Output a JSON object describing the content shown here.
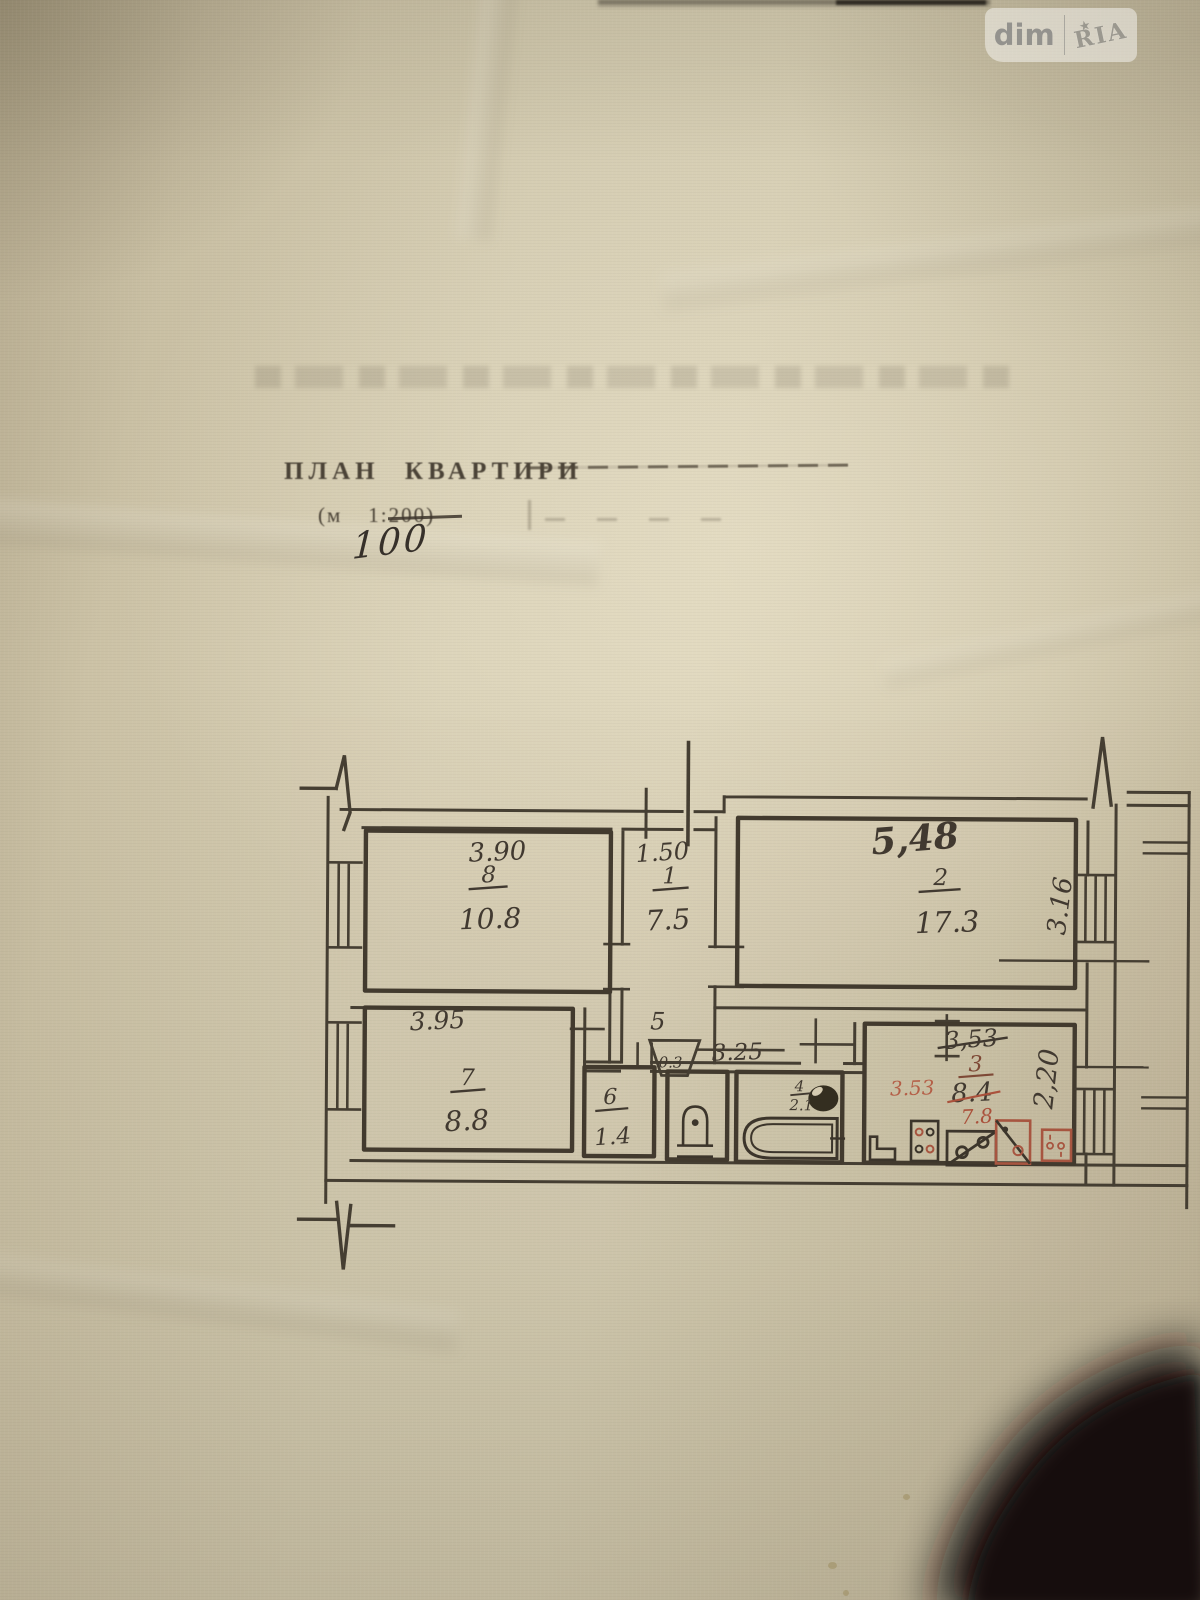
{
  "watermark": {
    "left": "dim",
    "right": "RIA",
    "star": "★"
  },
  "header": {
    "title": "ПЛАН КВАРТИРИ",
    "scale_prefix": "(м",
    "scale_ratio": "1:200)",
    "scale_corrected": "100"
  },
  "plan": {
    "rooms": [
      {
        "number": "8",
        "area": "10.8"
      },
      {
        "number": "1",
        "area": "7.5"
      },
      {
        "number": "2",
        "area": "17.3"
      },
      {
        "number": "7",
        "area": "8.8"
      },
      {
        "number": "6",
        "area": "1.4"
      },
      {
        "number": "5",
        "vent_area": "0.3"
      },
      {
        "number": "4",
        "area": "2.1"
      },
      {
        "number": "3",
        "area_old": "8.4",
        "area_new": "7.8"
      }
    ],
    "dimensions": {
      "room8_width": "3.90",
      "hall_width": "1.50",
      "room2_width": "5,48",
      "room2_depth": "3.16",
      "room7_width": "3.95",
      "corridor_length": "3.25",
      "kitchen_width_old": "3,53",
      "kitchen_width_red": "3.53",
      "kitchen_depth": "2,20"
    }
  }
}
